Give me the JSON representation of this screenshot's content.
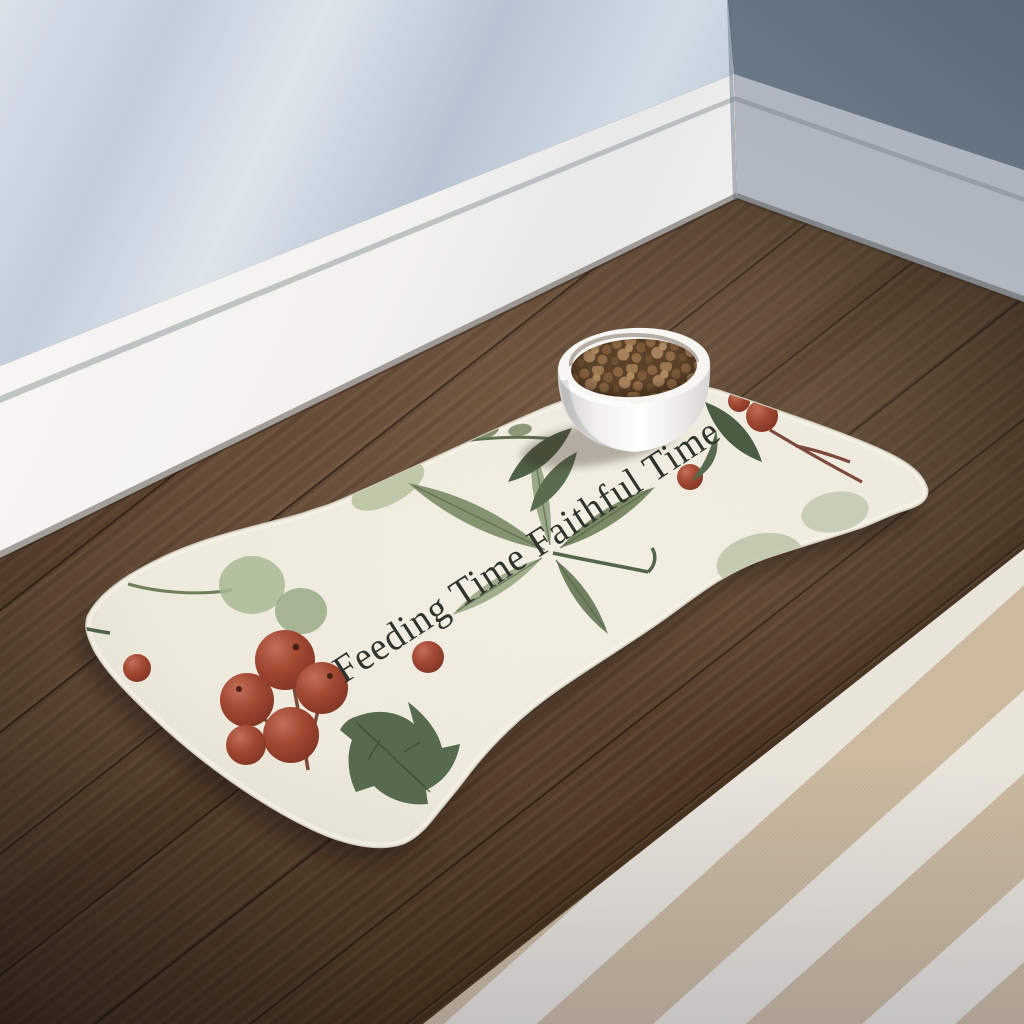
{
  "scene": {
    "description": "Product photo: bone-shaped pet feeding mat on a dark wood floor in a room corner, white bowl of kibble on the mat, striped rug at lower right",
    "room": {
      "wall": "light blue with soft window-light shadows",
      "baseboard": "white",
      "floor": "dark walnut wood planks",
      "rug": "beige and white striped"
    }
  },
  "mat": {
    "text": "Feeding Time Faithful Time",
    "shape": "bone",
    "base_color": "#ebe7d9",
    "text_color": "#2e342e",
    "pattern": [
      "watercolor holly leaves",
      "sage eucalyptus leaves",
      "red berry clusters"
    ]
  },
  "bowl": {
    "color": "#f6f5f2",
    "contents": "brown kibble"
  },
  "colors": {
    "wall_lit": "#ccd6e0",
    "wall_shadow": "#8b9aa9",
    "baseboard": "#f2f1ee",
    "wood_dark": "#3a2a1e",
    "wood_mid": "#5e4632",
    "rug_tan": "#cab79c",
    "rug_white": "#e8e4da",
    "leaf_dark": "#566a4e",
    "leaf_sage": "#a9b897",
    "berry": "#9e4530",
    "kibble": "#8a6540"
  }
}
